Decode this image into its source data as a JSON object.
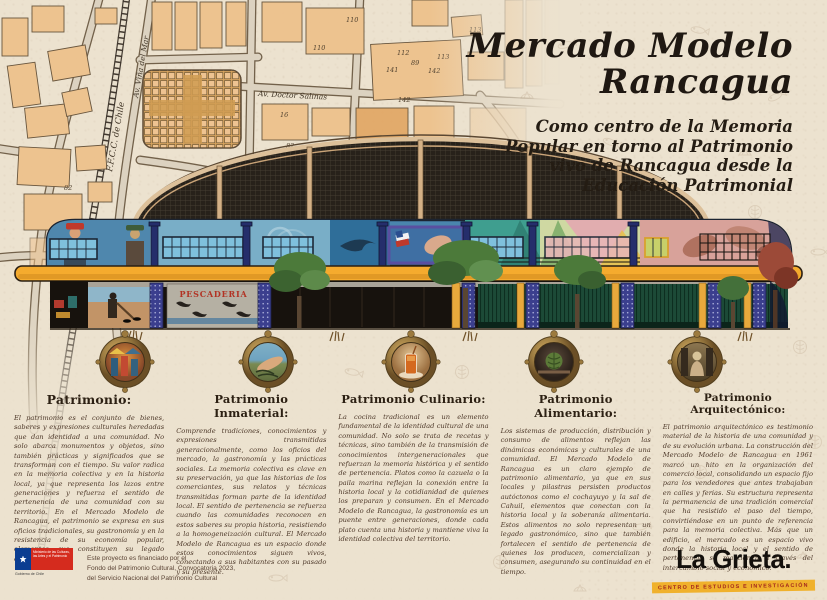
{
  "title": {
    "line1": "Mercado Modelo",
    "line2": "Rancagua"
  },
  "subtitle": {
    "lines": [
      "Como centro de la Memoria",
      "Popular en torno al Patrimonio",
      "vivo de Rancagua desde la",
      "Educación Patrimonial"
    ]
  },
  "map": {
    "street_labels": {
      "railway": "F.F.C.C. de Chile",
      "avenue1": "Av. Viña del Mar",
      "avenue2": "Av. Doctor Salinas"
    },
    "lot_numbers": [
      "110",
      "110",
      "112",
      "89",
      "113",
      "141",
      "142",
      "113",
      "142",
      "82",
      "82",
      "16"
    ]
  },
  "building": {
    "mural_sign": "PESCADERIA"
  },
  "medallions": [
    {
      "name": "market-people-scene"
    },
    {
      "name": "hands-weaving-seaweed"
    },
    {
      "name": "mote-con-huesillo-drink"
    },
    {
      "name": "artichoke-produce"
    },
    {
      "name": "heritage-statue"
    }
  ],
  "columns": [
    {
      "heading": "Patrimonio:",
      "body": "El patrimonio es el conjunto de bienes, saberes y expresiones culturales heredadas que dan identidad a una comunidad. No solo abarca monumentos y objetos, sino también prácticas y significados que se transforman con el tiempo. Su valor radica en la memoria colectiva y en la historia local, ya que representa los lazos entre generaciones y refuerza el sentido de pertenencia de una comunidad con su territorio. En el Mercado Modelo de Rancagua, el patrimonio se expresa en sus oficios tradicionales, su gastronomía y en la resistencia de su economía popular, elementos que constituyen su legado cultural y social."
    },
    {
      "heading": "Patrimonio Inmaterial:",
      "body": "Comprende tradiciones, conocimientos y expresiones transmitidas generacionalmente, como los oficios del mercado, la gastronomía y las prácticas sociales. La memoria colectiva es clave en su preservación, ya que las historias de los comerciantes, sus relatos y técnicas transmitidas forman parte de la identidad local. El sentido de pertenencia se refuerza cuando las comunidades reconocen en estos saberes su propia historia, resistiendo a la homogeneización cultural. El Mercado Modelo de Rancagua es un espacio donde estos conocimientos siguen vivos, conectando a sus habitantes con su pasado y su presente."
    },
    {
      "heading": "Patrimonio Culinario:",
      "body": "La cocina tradicional es un elemento fundamental de la identidad cultural de una comunidad. No solo se trata de recetas y técnicas, sino también de la transmisión de conocimientos intergeneracionales que refuerzan la memoria histórica y el sentido de pertenencia. Platos como la cazuela o la paila marina reflejan la conexión entre la historia local y la cotidianidad de quienes los preparan y consumen. En el Mercado Modelo de Rancagua, la gastronomía es un puente entre generaciones, donde cada plato cuenta una historia y mantiene viva la identidad colectiva del territorio."
    },
    {
      "heading": "Patrimonio Alimentario:",
      "body": "Los sistemas de producción, distribución y consumo de alimentos reflejan las dinámicas económicas y culturales de una comunidad. El Mercado Modelo de Rancagua es un claro ejemplo de patrimonio alimentario, ya que en sus locales y pilastras persisten productos autóctonos como el cochayuyo y la sal de Cahuil, elementos que conectan con la historia local y la soberanía alimentaria. Estos alimentos no solo representan un legado gastronómico, sino que también fortalecen el sentido de pertenencia de quienes los producen, comercializan y consumen, asegurando su continuidad en el tiempo."
    },
    {
      "heading": "Patrimonio Arquitectónico:",
      "body": "El patrimonio arquitectónico es testimonio material de la historia de una comunidad y de su evolución urbana. La construcción del Mercado Modelo de Rancagua en 1961 marcó un hito en la organización del comercio local, consolidando un espacio fijo para los vendedores que antes trabajaban en calles y ferias. Su estructura representa la permanencia de una tradición comercial que ha resistido el paso del tiempo, convirtiéndose en un punto de referencia para la memoria colectiva. Más que un edificio, el mercado es un espacio vivo donde la historia local y el sentido de pertenencia se mantienen a través del intercambio social y económico."
    }
  ],
  "footer": {
    "funding_lines": [
      "Este proyecto es financiado por el",
      "Fondo del Patrimonio Cultural, Convocatoria 2023,",
      "del Servicio Nacional del Patrimonio Cultural"
    ],
    "gov_logo": {
      "ministry": "Ministerio de las Culturas, las Artes y el Patrimonio",
      "government": "Gobierno de Chile"
    },
    "brand": {
      "name": "La Grieta.",
      "tagline": "CENTRO DE ESTUDIOS E INVESTIGACIÓN"
    }
  },
  "colors": {
    "paper": "#ece2cf",
    "map_building": "#eec28d",
    "slab_yellow": "#f5ab2e",
    "mural_blue": "#4a85ad",
    "shutter_green": "#1c4a37",
    "banner_yellow": "#f0b12c",
    "banner_red": "#a3261c",
    "gov_blue": "#0b3d91",
    "gov_red": "#d52b1e"
  }
}
